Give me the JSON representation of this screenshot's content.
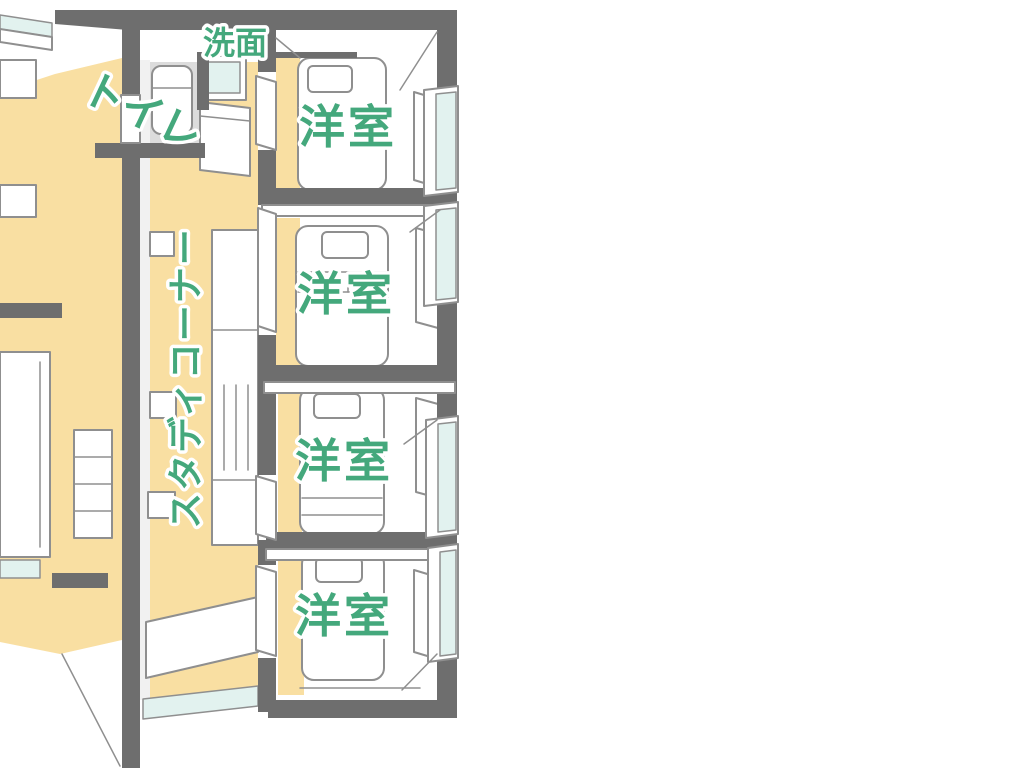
{
  "palette": {
    "background": "#ffffff",
    "wall_gray": "#6e6e6e",
    "floor_orange": "#f9dfa2",
    "window_glass_blue": "#e2f2ef",
    "toilet_floor_gray": "#dcdcdc",
    "furniture_outline_gray": "#8f8f8f",
    "label_green": "#44a87c",
    "label_halo_white": "#ffffff"
  },
  "floor_plan": {
    "type": "hand-drawn axonometric house floor plan (second floor)",
    "areas": [
      {
        "id": "washbasin",
        "label": "洗面"
      },
      {
        "id": "toilet",
        "label": "トイレ"
      },
      {
        "id": "study-corner",
        "label": "スタディコーナー"
      },
      {
        "id": "western-room-1",
        "label": "洋室"
      },
      {
        "id": "western-room-2",
        "label": "洋室"
      },
      {
        "id": "western-room-3",
        "label": "洋室"
      },
      {
        "id": "western-room-4",
        "label": "洋室"
      }
    ]
  }
}
